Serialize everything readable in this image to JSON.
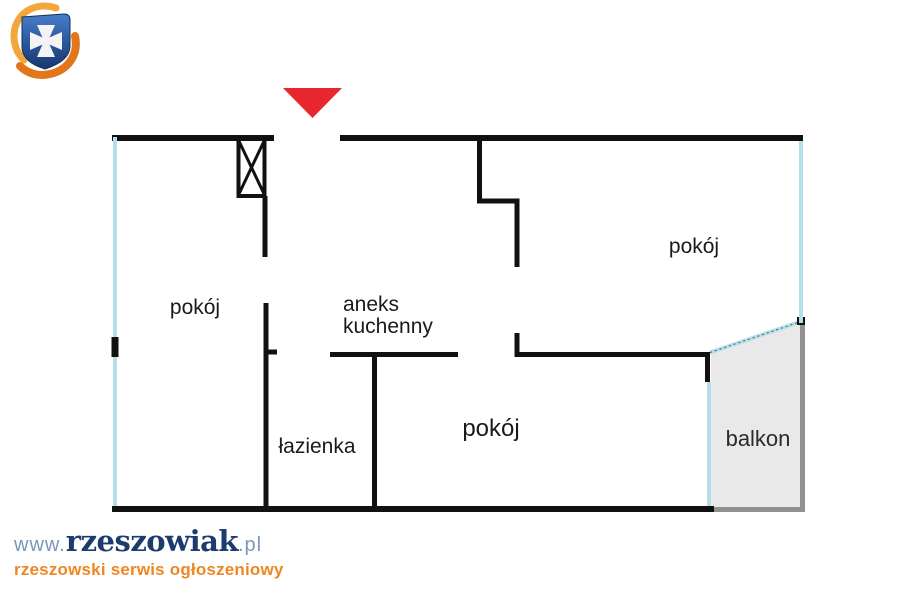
{
  "floorplan": {
    "rooms": {
      "room_left": {
        "label": "pokój"
      },
      "room_top_right": {
        "label": "pokój"
      },
      "room_bottom": {
        "label": "pokój"
      },
      "kitchen": {
        "label": "aneks kuchenny"
      },
      "bathroom": {
        "label": "łazienka"
      },
      "balcony": {
        "label": "balkon"
      }
    },
    "colors": {
      "wall": "#111111",
      "window_glazing": "#b3dfe9",
      "balcony_fill": "#e9e9e9",
      "balcony_border": "#919191",
      "entrance_marker_red": "#e7262e"
    },
    "icons": {
      "entrance_marker": "red-down-triangle",
      "chimney_shaft": "rectangle-with-x-cross"
    }
  },
  "branding": {
    "site_prefix": "www.",
    "site_name": "rzeszowiak",
    "site_tld": ".pl",
    "tagline": "rzeszowski serwis ogłoszeniowy",
    "logo_icon": "rzeszow-shield-cross-with-orange-arrows",
    "colors": {
      "site_name": "#1d3c6e",
      "site_muted": "#7b97bb",
      "tagline": "#ee8722",
      "logo_blue": "#2c59a0",
      "logo_orange": "#e87a1e"
    }
  }
}
